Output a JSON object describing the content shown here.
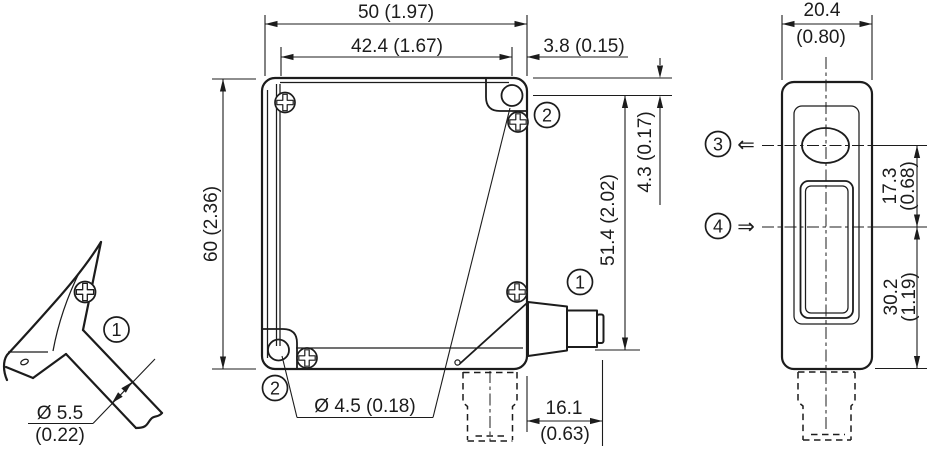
{
  "drawing_title": "sensor dimensional drawing",
  "colors": {
    "line": "#1c1c1c",
    "background": "#ffffff"
  },
  "dimensions": {
    "total_width": "50 (1.97)",
    "hole_spacing_h": "42.4 (1.67)",
    "hole_edge_offset": "3.8 (0.15)",
    "total_height": "60 (2.36)",
    "hole_top_offset": "4.3 (0.17)",
    "hole_spacing_v": "51.4 (2.02)",
    "mounting_hole_dia": "Ø 4.5 (0.18)",
    "connector_length_mm": "16.1",
    "connector_length_in": "(0.63)",
    "cable_dia_mm": "Ø 5.5",
    "cable_dia_in": "(0.22)",
    "side_width_mm": "20.4",
    "side_width_in": "(0.80)",
    "axis_spacing_mm": "17.3",
    "axis_spacing_in": "(0.68)",
    "axis_to_bottom_mm": "30.2",
    "axis_to_bottom_in": "(1.19)"
  },
  "markers": {
    "cable_connection": "1",
    "plug_connection": "1",
    "mounting_hole_top": "2",
    "mounting_hole_bottom": "2",
    "sender_axis": "3",
    "receiver_axis": "4",
    "sender_arrow": "⇐",
    "receiver_arrow": "⇒"
  }
}
